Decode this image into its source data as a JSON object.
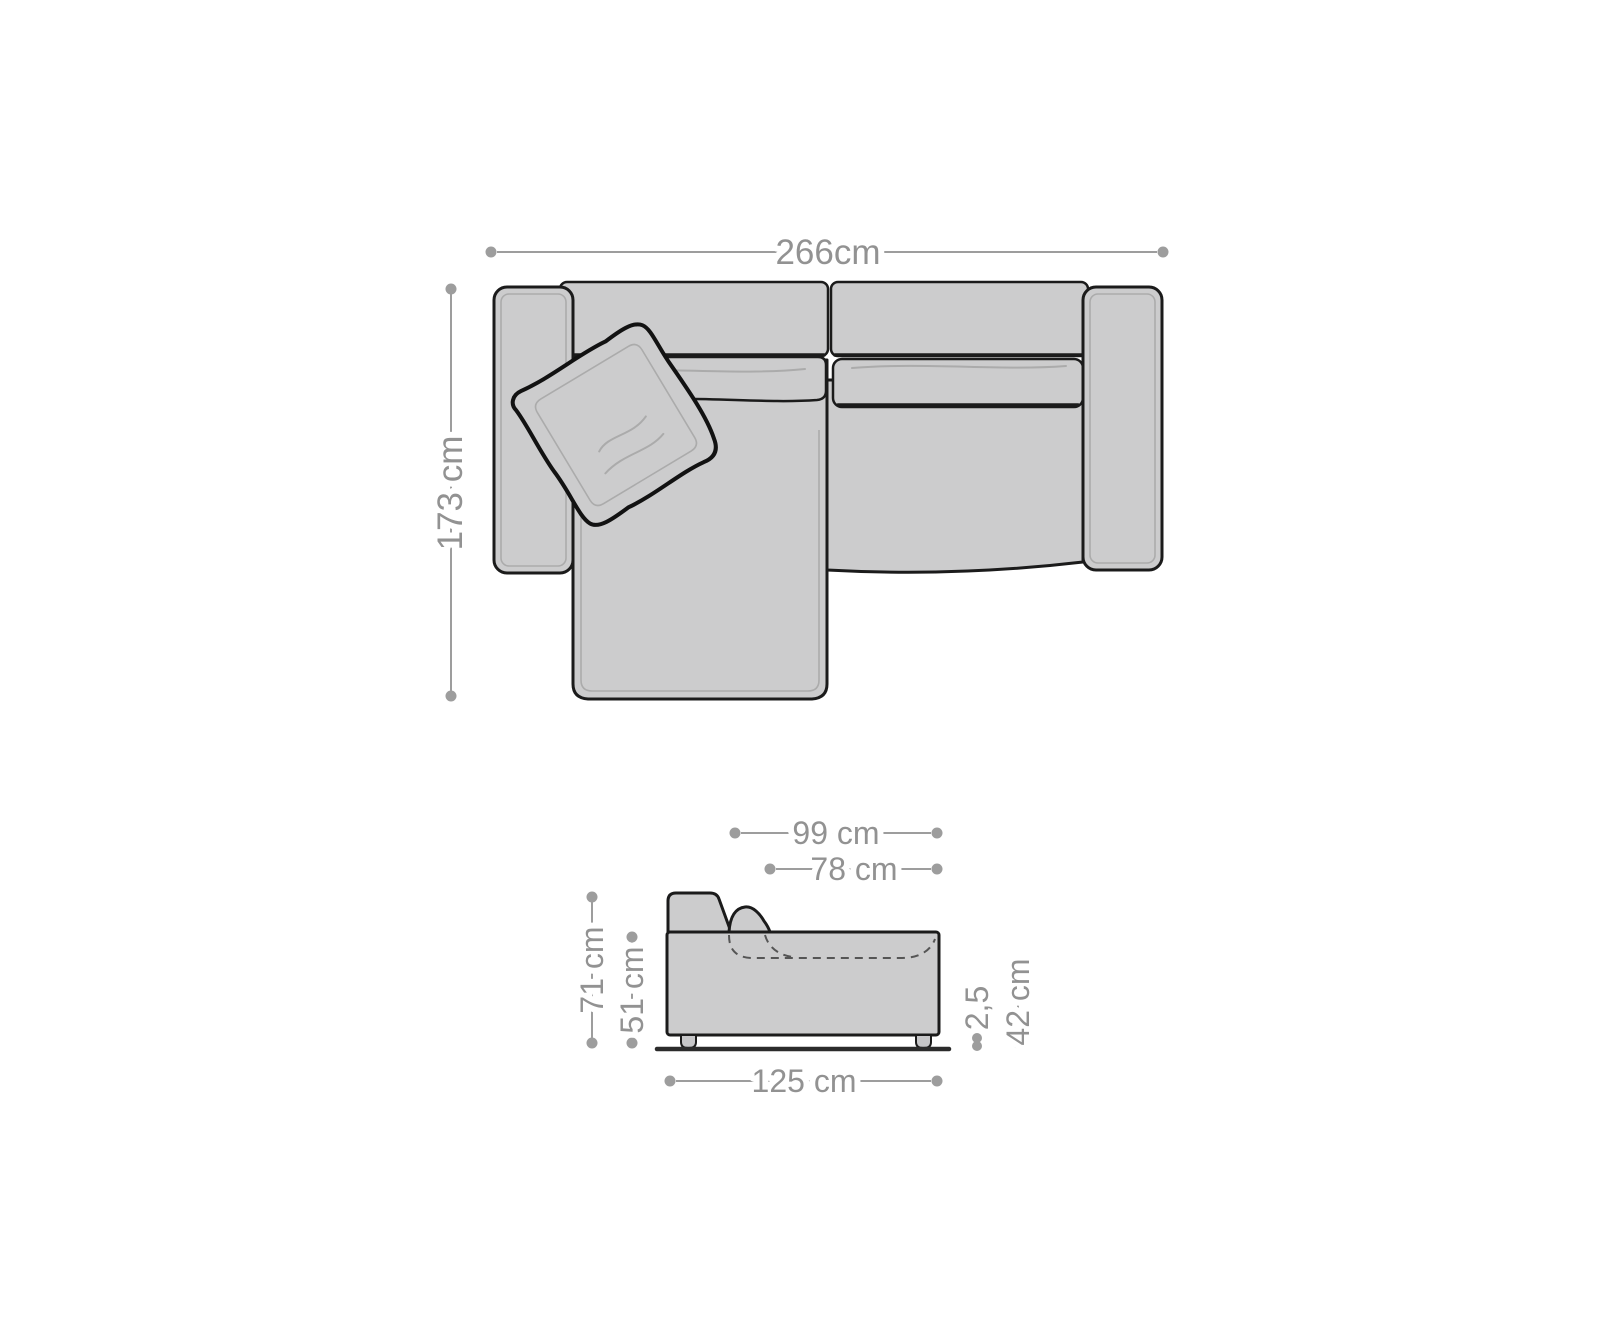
{
  "diagram": {
    "colors": {
      "background": "#ffffff",
      "sofa_fill": "#cccccd",
      "sofa_fill_alt": "#c6c6c8",
      "outline": "#1b1b1b",
      "detail_line": "#ababab",
      "dimension_line": "#9d9d9d",
      "dimension_text": "#929292",
      "floor_line": "#2b2b2b",
      "dashed_line": "#555555"
    },
    "top_view": {
      "overall_width_label": "266cm",
      "overall_depth_label": "173 cm"
    },
    "side_view": {
      "total_depth_label": "99 cm",
      "seat_depth_label": "78 cm",
      "total_height_label": "71 cm",
      "body_height_label": "51 cm",
      "base_length_label": "125 cm",
      "floor_clearance_label": "2,5",
      "seat_height_label": "42 cm"
    }
  }
}
